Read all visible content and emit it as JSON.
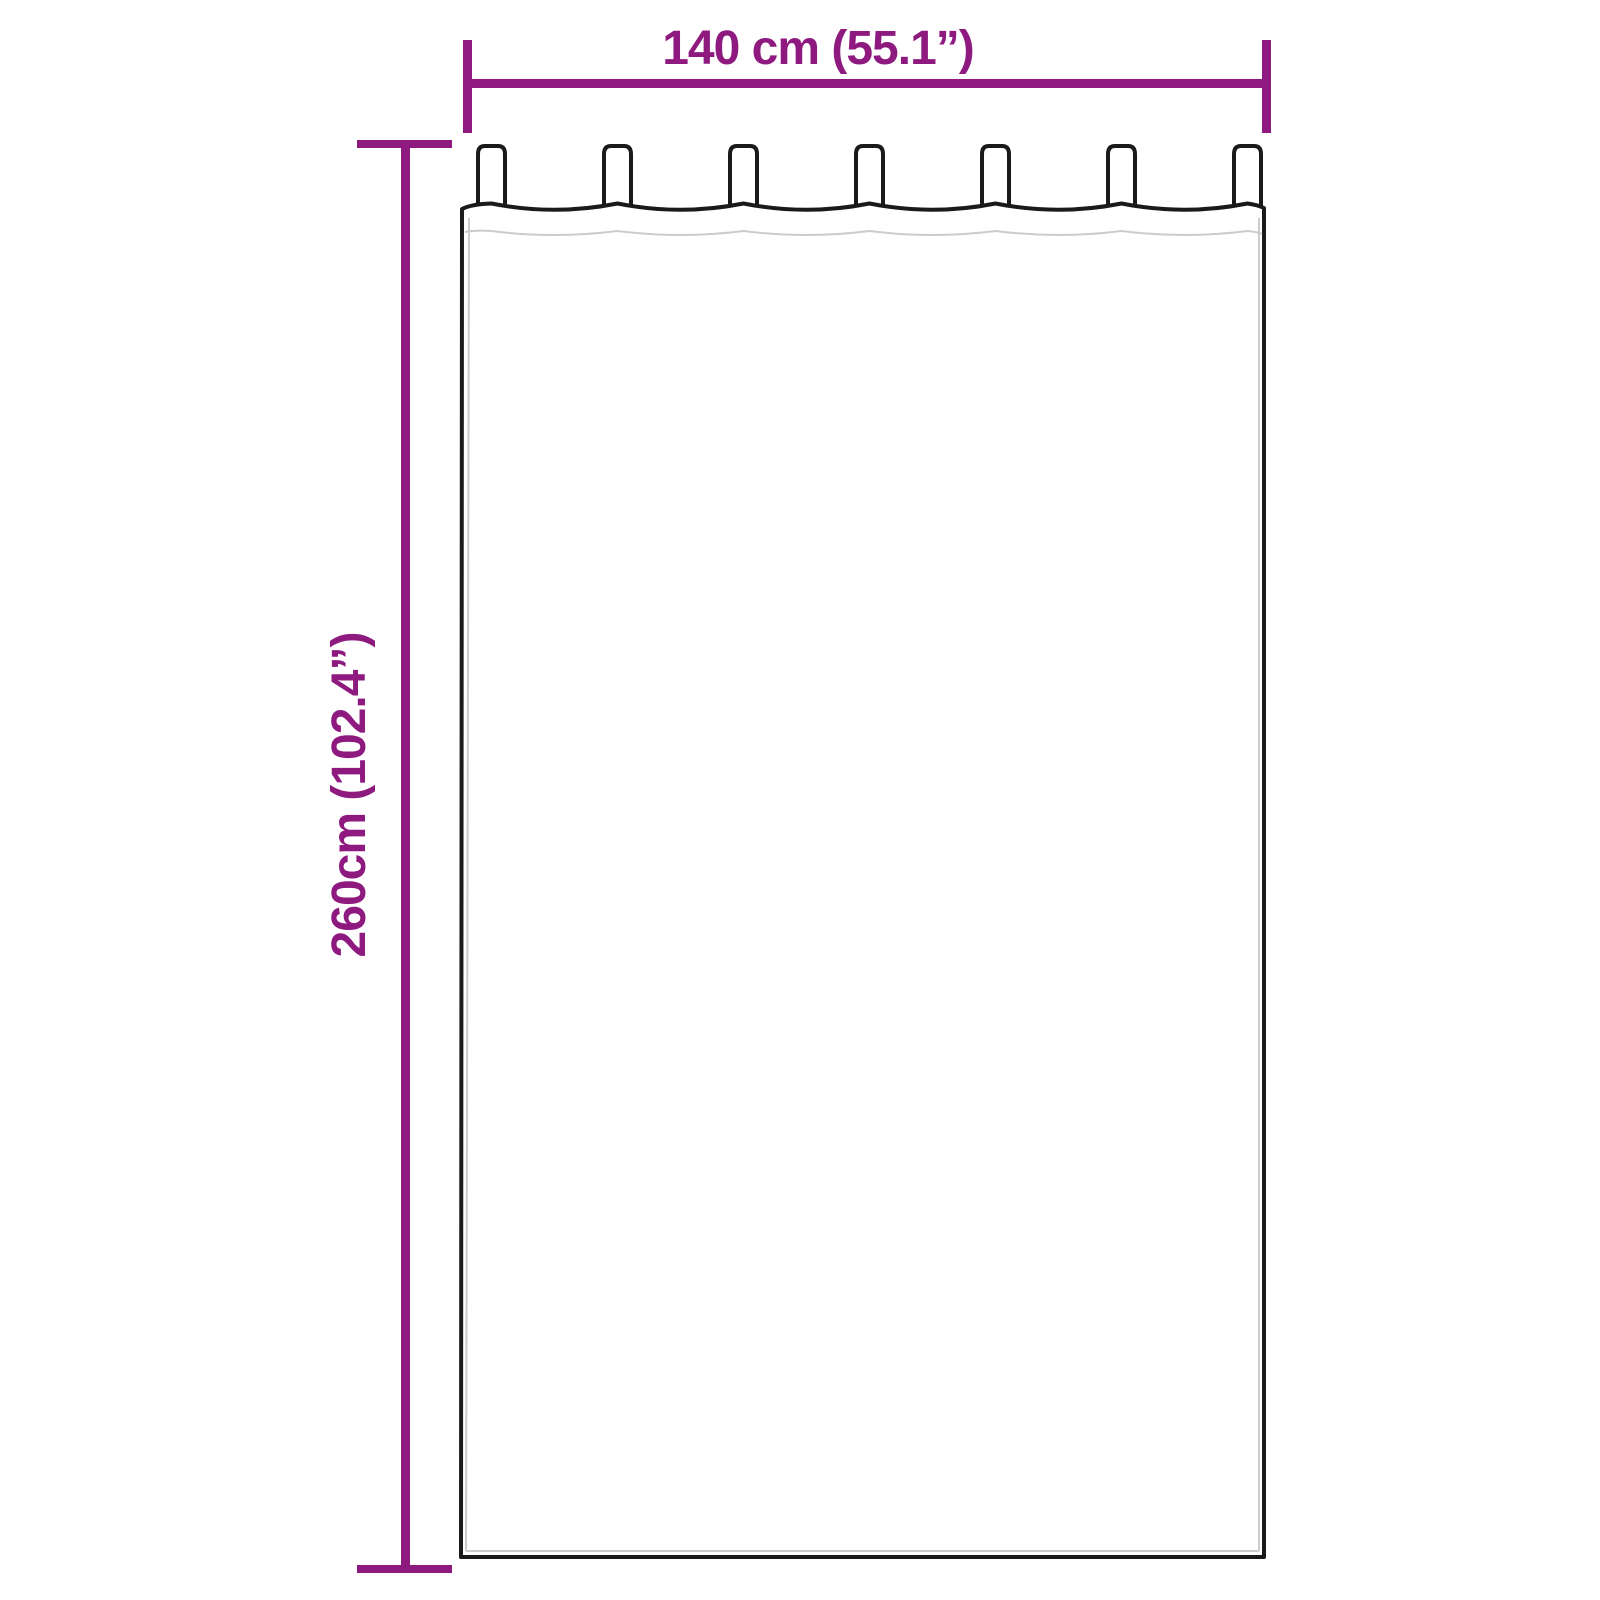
{
  "diagram": {
    "width_label": "140 cm (55.1”)",
    "height_label": "260cm (102.4”)"
  },
  "product": {
    "item": "tab-top-curtain",
    "tab_count": 7
  },
  "colors": {
    "dimension": "#8E1A80",
    "outline": "#1a1a1a",
    "faint_line": "#cccccc",
    "background": "#ffffff"
  }
}
